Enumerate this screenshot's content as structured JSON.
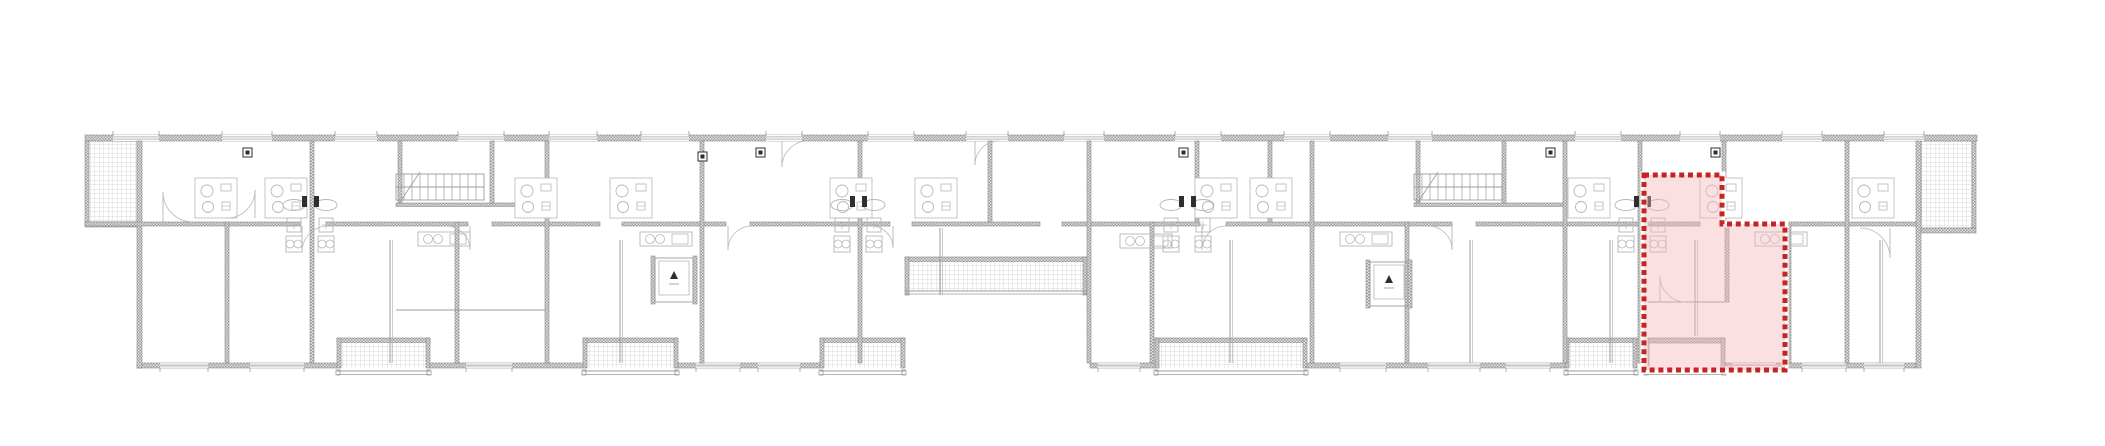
{
  "canvas": {
    "width": 2105,
    "height": 446,
    "background": "#ffffff"
  },
  "palette": {
    "line": "#9b9b9b",
    "line_light": "#b7b7b7",
    "line_dark": "#6f6f6f",
    "wall_checker_dark": "#9e9e9e",
    "wall_checker_light": "#e4e4e4",
    "wall_edge": "#8d8d8d",
    "tile_line": "#cccccc",
    "fixture_dark": "#2e2e2e",
    "highlight_fill": "#f2b6b6",
    "highlight_fill_opacity": 0.42,
    "highlight_stroke": "#c32525",
    "highlight_halo": "#ffffff"
  },
  "building": {
    "top_wall": {
      "x1": 85,
      "x2": 1977,
      "y": 135,
      "h": 6
    },
    "bottom_wall": {
      "y": 363,
      "h": 5,
      "segments": [
        [
          137,
          337
        ],
        [
          430,
          583
        ],
        [
          678,
          820
        ],
        [
          1090,
          1155
        ],
        [
          1307,
          1565
        ],
        [
          1725,
          1916
        ]
      ]
    },
    "left_wall": {
      "x": 137,
      "y": 141,
      "w": 5,
      "h": 227
    },
    "right_wall": {
      "x": 1916,
      "y": 141,
      "w": 5,
      "h": 227
    },
    "mid_wall": {
      "y": 222,
      "h": 4,
      "segments": [
        [
          85,
          300
        ],
        [
          326,
          468
        ],
        [
          492,
          600
        ],
        [
          622,
          726
        ],
        [
          750,
          890
        ],
        [
          912,
          1040
        ],
        [
          1062,
          1200
        ],
        [
          1226,
          1452
        ],
        [
          1476,
          1700
        ],
        [
          1726,
          1916
        ]
      ]
    },
    "aux_walls": [
      {
        "x1": 396,
        "x2": 545,
        "y": 203
      },
      {
        "x1": 1414,
        "x2": 1563,
        "y": 203
      }
    ],
    "vertical_walls": {
      "full": [
        310,
        545,
        700,
        858,
        1087,
        1310,
        1563,
        1638,
        1845
      ],
      "lower": [
        [
          225,
          222,
          363
        ],
        [
          455,
          222,
          363
        ],
        [
          1150,
          222,
          363
        ],
        [
          1405,
          222,
          363
        ],
        [
          1725,
          224,
          302
        ],
        [
          1787,
          224,
          363
        ]
      ],
      "upper": [
        [
          398,
          141,
          203
        ],
        [
          490,
          141,
          203
        ],
        [
          988,
          141,
          222
        ],
        [
          1195,
          141,
          222
        ],
        [
          1268,
          141,
          222
        ],
        [
          1416,
          141,
          203
        ],
        [
          1502,
          141,
          203
        ],
        [
          1722,
          141,
          224
        ]
      ]
    },
    "top_windows": [
      [
        113,
        46
      ],
      [
        222,
        50
      ],
      [
        335,
        42
      ],
      [
        458,
        46
      ],
      [
        549,
        48
      ],
      [
        641,
        48
      ],
      [
        766,
        36
      ],
      [
        868,
        46
      ],
      [
        966,
        42
      ],
      [
        1064,
        40
      ],
      [
        1175,
        46
      ],
      [
        1284,
        46
      ],
      [
        1388,
        44
      ],
      [
        1575,
        46
      ],
      [
        1680,
        40
      ],
      [
        1782,
        40
      ],
      [
        1884,
        40
      ]
    ],
    "bottom_windows": [
      [
        160,
        48
      ],
      [
        250,
        54
      ],
      [
        466,
        46
      ],
      [
        696,
        44
      ],
      [
        758,
        42
      ],
      [
        1098,
        42
      ],
      [
        1340,
        46
      ],
      [
        1428,
        52
      ],
      [
        1506,
        44
      ],
      [
        1732,
        44
      ],
      [
        1802,
        44
      ],
      [
        1864,
        40
      ]
    ]
  },
  "terraces": [
    {
      "x": 86,
      "y": 141,
      "w": 51,
      "h": 81,
      "side": "left"
    },
    {
      "x": 1921,
      "y": 141,
      "w": 52,
      "h": 87,
      "side": "right"
    }
  ],
  "loggia": {
    "x": 905,
    "y": 257,
    "w": 182,
    "h": 38
  },
  "balconies": [
    {
      "x": 337,
      "y": 338,
      "w": 93,
      "h": 36,
      "tiled": true
    },
    {
      "x": 583,
      "y": 338,
      "w": 95,
      "h": 36,
      "tiled": true
    },
    {
      "x": 820,
      "y": 338,
      "w": 85,
      "h": 36,
      "tiled": true
    },
    {
      "x": 1155,
      "y": 338,
      "w": 152,
      "h": 36,
      "tiled": true
    },
    {
      "x": 1565,
      "y": 338,
      "w": 72,
      "h": 36,
      "tiled": true
    },
    {
      "x": 1645,
      "y": 338,
      "w": 80,
      "h": 36,
      "tiled": false
    }
  ],
  "stairs": [
    {
      "x": 396,
      "y": 174,
      "w": 88,
      "h": 26,
      "step": 8
    },
    {
      "x": 1414,
      "y": 174,
      "w": 88,
      "h": 26,
      "step": 8
    }
  ],
  "elevators": [
    {
      "x": 655,
      "y": 258,
      "w": 38,
      "h": 44
    },
    {
      "x": 1370,
      "y": 262,
      "w": 38,
      "h": 44
    }
  ],
  "bathroom_pods": [
    195,
    265,
    515,
    610,
    830,
    915,
    1195,
    1250,
    1568,
    1700,
    1852
  ],
  "service_stacks": [
    310,
    858,
    1187,
    1642
  ],
  "dark_units": [
    [
      243,
      148
    ],
    [
      756,
      148
    ],
    [
      1179,
      148
    ],
    [
      1546,
      148
    ],
    [
      1711,
      148
    ],
    [
      698,
      152
    ]
  ],
  "kitchens": [
    [
      418,
      232
    ],
    [
      640,
      232
    ],
    [
      1120,
      234
    ],
    [
      1340,
      232
    ],
    [
      1755,
      232
    ]
  ],
  "thin_dividers": [
    [
      390,
      240,
      363
    ],
    [
      620,
      240,
      363
    ],
    [
      940,
      228,
      295
    ],
    [
      1230,
      240,
      363
    ],
    [
      1470,
      240,
      363
    ],
    [
      1610,
      240,
      363
    ],
    [
      1695,
      240,
      336
    ],
    [
      1880,
      240,
      363
    ]
  ],
  "thin_hlines": [
    [
      1643,
      1725,
      302
    ],
    [
      396,
      545,
      310
    ]
  ],
  "doors": [
    [
      302,
      226,
      26,
      1,
      1
    ],
    [
      470,
      226,
      24,
      -1,
      1
    ],
    [
      728,
      226,
      24,
      1,
      1
    ],
    [
      893,
      226,
      22,
      -1,
      1
    ],
    [
      1202,
      226,
      24,
      1,
      1
    ],
    [
      1452,
      226,
      24,
      -1,
      1
    ],
    [
      255,
      218,
      28,
      -1,
      -1
    ],
    [
      1660,
      302,
      26,
      1,
      -1
    ],
    [
      782,
      141,
      26,
      1,
      1
    ],
    [
      975,
      141,
      24,
      1,
      1
    ],
    [
      163,
      222,
      30,
      1,
      -1
    ],
    [
      1890,
      228,
      30,
      -1,
      1
    ]
  ],
  "highlight": {
    "unit_name": "selected-apartment",
    "polygon": [
      [
        1644,
        175
      ],
      [
        1722,
        175
      ],
      [
        1722,
        224
      ],
      [
        1785,
        224
      ],
      [
        1785,
        370
      ],
      [
        1644,
        370
      ]
    ],
    "dash": [
      5,
      3.8
    ],
    "stroke_width": 5
  }
}
